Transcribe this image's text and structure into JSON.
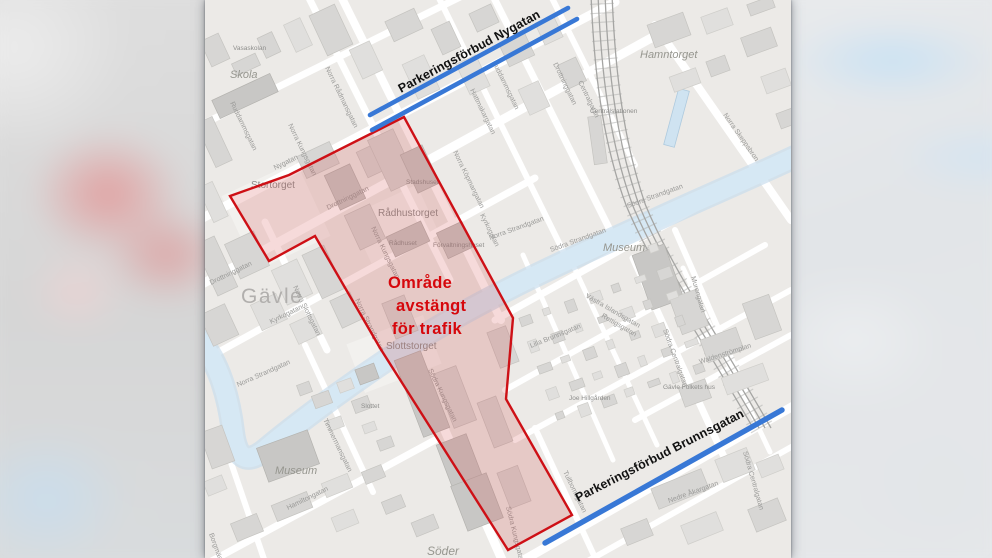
{
  "annotations": {
    "restricted_area": {
      "label_lines": [
        "Område",
        "avstängt",
        "för trafik"
      ],
      "polygon_points": [
        [
          199,
          117
        ],
        [
          84,
          175
        ],
        [
          25,
          196
        ],
        [
          64,
          261
        ],
        [
          110,
          236
        ],
        [
          175,
          348
        ],
        [
          303,
          550
        ],
        [
          367,
          515
        ],
        [
          301,
          399
        ],
        [
          308,
          318
        ]
      ],
      "stroke_color": "#ce1016",
      "fill_color": "#d04545",
      "fill_opacity": 0.2,
      "text_color": "#d6070c"
    },
    "parking_bans": [
      {
        "street": "Nygatan",
        "label": "Parkeringsförbud Nygatan",
        "color": "#3878d6",
        "line_width": 4.6,
        "lines": [
          [
            165,
            115,
            363,
            8
          ],
          [
            167,
            130,
            372,
            19
          ]
        ]
      },
      {
        "street": "Brunnsgatan",
        "label": "Parkeringsförbud Brunnsgatan",
        "color": "#3878d6",
        "line_width": 5.4,
        "lines": [
          [
            340,
            543,
            577,
            410
          ]
        ]
      }
    ],
    "label_color": "#111111"
  },
  "map": {
    "city_label": {
      "text": "Gävle",
      "pos": [
        36,
        303
      ],
      "size": 21
    },
    "place_labels": [
      {
        "text": "Skola",
        "pos": [
          25,
          78
        ],
        "size": 11,
        "italic": true
      },
      {
        "text": "Vasaskolan",
        "pos": [
          28,
          50
        ],
        "size": 6.5,
        "italic": false
      },
      {
        "text": "Stortorget",
        "pos": [
          46,
          188
        ],
        "size": 10,
        "italic": false
      },
      {
        "text": "Rådhustorget",
        "pos": [
          173,
          216
        ],
        "size": 10,
        "italic": false
      },
      {
        "text": "Stadshuset",
        "pos": [
          201,
          184
        ],
        "size": 6.5,
        "italic": false
      },
      {
        "text": "Rådhuset",
        "pos": [
          184,
          245
        ],
        "size": 6.5,
        "italic": false
      },
      {
        "text": "Förvaltningshuset",
        "pos": [
          228,
          247
        ],
        "size": 6.5,
        "italic": false
      },
      {
        "text": "Hamntorget",
        "pos": [
          435,
          58
        ],
        "size": 11,
        "italic": true
      },
      {
        "text": "Centralstationen",
        "pos": [
          385,
          113
        ],
        "size": 6.5,
        "italic": false
      },
      {
        "text": "Museum",
        "pos": [
          398,
          251
        ],
        "size": 11,
        "italic": true
      },
      {
        "text": "Museum",
        "pos": [
          70,
          474
        ],
        "size": 11,
        "italic": true
      },
      {
        "text": "Slottstorget",
        "pos": [
          181,
          349
        ],
        "size": 10,
        "italic": false
      },
      {
        "text": "Slottet",
        "pos": [
          156,
          408
        ],
        "size": 6.5,
        "italic": false
      },
      {
        "text": "Söder",
        "pos": [
          222,
          555
        ],
        "size": 12,
        "italic": true
      },
      {
        "text": "Gävle Folkets hus",
        "pos": [
          458,
          389
        ],
        "size": 6.5,
        "italic": false
      },
      {
        "text": "Joe Hillgården",
        "pos": [
          364,
          400
        ],
        "size": 6.5,
        "italic": false
      }
    ],
    "street_labels": [
      {
        "text": "Nygatan",
        "pos": [
          70,
          170
        ],
        "rot": -26
      },
      {
        "text": "Ruddammsgatan",
        "pos": [
          25,
          103
        ],
        "rot": 64
      },
      {
        "text": "Ruddammsgatan",
        "pos": [
          287,
          62
        ],
        "rot": 64
      },
      {
        "text": "Norra Rådmansgatan",
        "pos": [
          120,
          68
        ],
        "rot": 64
      },
      {
        "text": "Hattmakargatan",
        "pos": [
          265,
          90
        ],
        "rot": 64
      },
      {
        "text": "Norra Köpmangatan",
        "pos": [
          248,
          152
        ],
        "rot": 64
      },
      {
        "text": "Norra Kungsgatan",
        "pos": [
          83,
          125
        ],
        "rot": 64
      },
      {
        "text": "Norra Kungsgatan",
        "pos": [
          166,
          228
        ],
        "rot": 64
      },
      {
        "text": "Drottninggatan",
        "pos": [
          123,
          210
        ],
        "rot": -26
      },
      {
        "text": "Drottninggatan",
        "pos": [
          6,
          285
        ],
        "rot": -26
      },
      {
        "text": "Drottninggatan",
        "pos": [
          348,
          64
        ],
        "rot": 64
      },
      {
        "text": "Kyrkogatan",
        "pos": [
          66,
          324
        ],
        "rot": -26
      },
      {
        "text": "Kyrkogatan",
        "pos": [
          275,
          215
        ],
        "rot": 64
      },
      {
        "text": "Norra Slottsgatan",
        "pos": [
          88,
          287
        ],
        "rot": 64
      },
      {
        "text": "Norra Strandgatan",
        "pos": [
          33,
          387
        ],
        "rot": -24
      },
      {
        "text": "Norra Strandgatan",
        "pos": [
          150,
          300
        ],
        "rot": 64
      },
      {
        "text": "Norra Strandgatan",
        "pos": [
          285,
          240
        ],
        "rot": -20
      },
      {
        "text": "Södra Strandgatan",
        "pos": [
          346,
          252
        ],
        "rot": -20
      },
      {
        "text": "Södra Strandgatan",
        "pos": [
          423,
          208
        ],
        "rot": -20
      },
      {
        "text": "Södra Kungsgatan",
        "pos": [
          223,
          370
        ],
        "rot": 64
      },
      {
        "text": "Södra Kungsgatan",
        "pos": [
          301,
          507
        ],
        "rot": 76
      },
      {
        "text": "Norra Skeppsbron",
        "pos": [
          518,
          115
        ],
        "rot": 55
      },
      {
        "text": "Centralgatan",
        "pos": [
          373,
          82
        ],
        "rot": 64
      },
      {
        "text": "Murengatan",
        "pos": [
          486,
          277
        ],
        "rot": 74
      },
      {
        "text": "Västra Islandsgatan",
        "pos": [
          380,
          297
        ],
        "rot": 30
      },
      {
        "text": "Rettigsgatan",
        "pos": [
          396,
          317
        ],
        "rot": 30
      },
      {
        "text": "Södra Centralgatan",
        "pos": [
          458,
          330
        ],
        "rot": 70
      },
      {
        "text": "Södra Centralgatan",
        "pos": [
          538,
          452
        ],
        "rot": 74
      },
      {
        "text": "Waldenströmplan",
        "pos": [
          495,
          364
        ],
        "rot": -18
      },
      {
        "text": "Lilla Brunnsgatan",
        "pos": [
          326,
          348
        ],
        "rot": -22
      },
      {
        "text": "Timmermansgatan",
        "pos": [
          118,
          420
        ],
        "rot": 64
      },
      {
        "text": "Tullbomsgatan",
        "pos": [
          358,
          472
        ],
        "rot": 64
      },
      {
        "text": "Hamiltongatan",
        "pos": [
          83,
          510
        ],
        "rot": -26
      },
      {
        "text": "Borgmästarplan",
        "pos": [
          4,
          534
        ],
        "rot": 70
      },
      {
        "text": "Nedre Åkargatan",
        "pos": [
          464,
          503
        ],
        "rot": -20
      }
    ]
  }
}
